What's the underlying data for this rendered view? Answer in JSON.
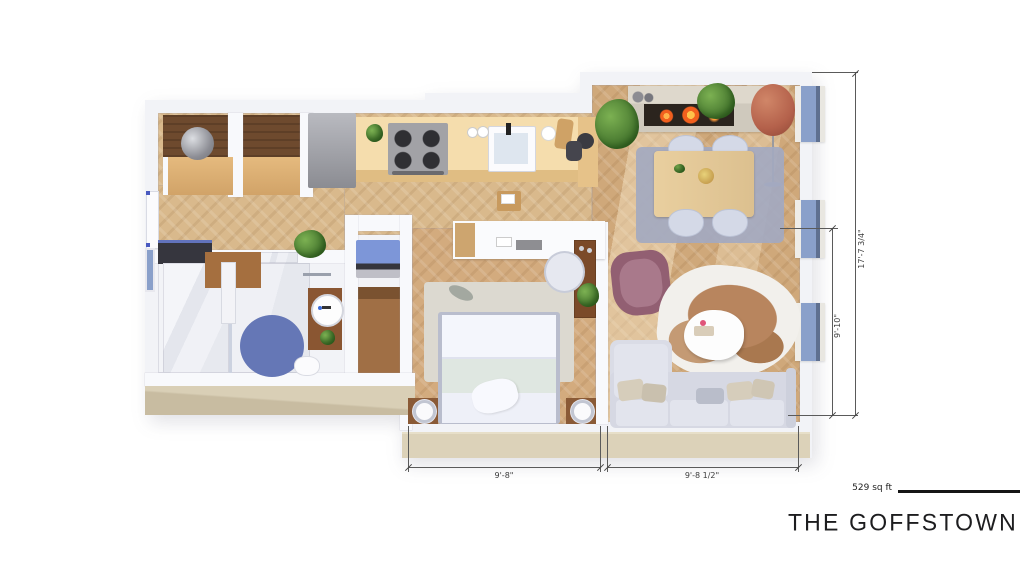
{
  "meta": {
    "title": "THE GOFFSTOWN",
    "area_label": "529 sq ft"
  },
  "dimensions": {
    "total_height": "17'-7 3/4\"",
    "living_height": "9'-10\"",
    "bedroom_width": "9'-8\"",
    "living_width": "9'-8 1/2\""
  },
  "palette": {
    "floor_wood": "#d9b98c",
    "wall": "#f2f3f7",
    "accent_blue": "#7d96d8",
    "terrace_beige": "#dcd2b9",
    "bath_rug_blue": "#6577b6",
    "dim_line": "#5a5a5a"
  }
}
